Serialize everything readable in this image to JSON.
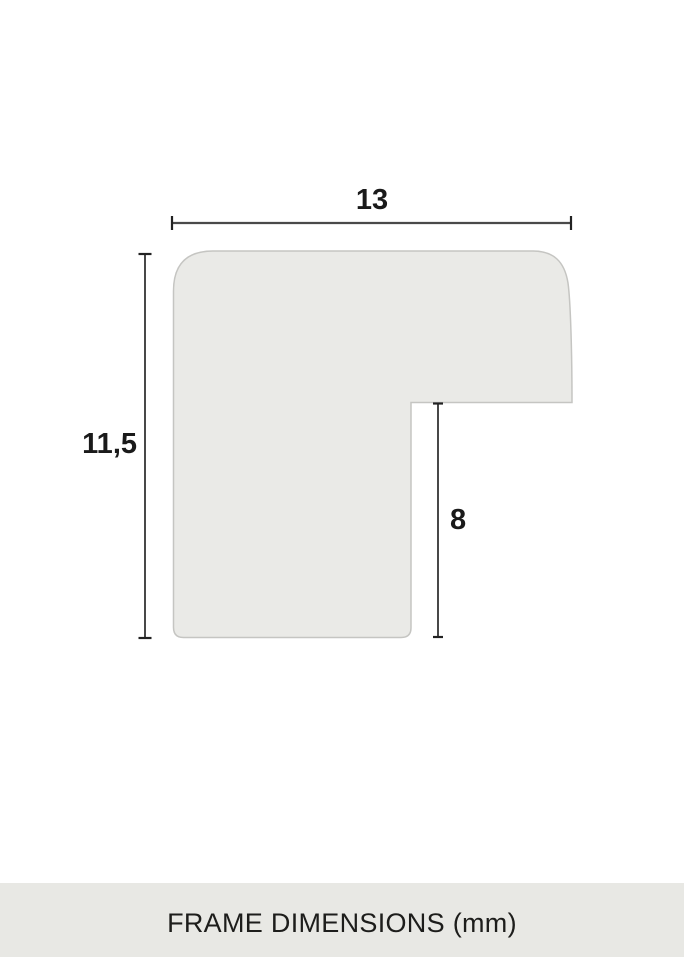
{
  "diagram": {
    "type": "picture-frame-moulding-profile-cross-section",
    "shape": {
      "fill": "#eaeae7",
      "stroke": "#c5c5c2"
    },
    "line_color": "#444444",
    "dimensions": {
      "width": {
        "label": "13",
        "value": 13,
        "unit": "mm"
      },
      "height": {
        "label": "11,5",
        "value": 11.5,
        "unit": "mm"
      },
      "rabbet": {
        "label": "8",
        "value": 8,
        "unit": "mm"
      }
    }
  },
  "footer": {
    "caption": "FRAME DIMENSIONS (mm)",
    "background": "#e8e8e4",
    "text_color": "#1d1d1b"
  }
}
